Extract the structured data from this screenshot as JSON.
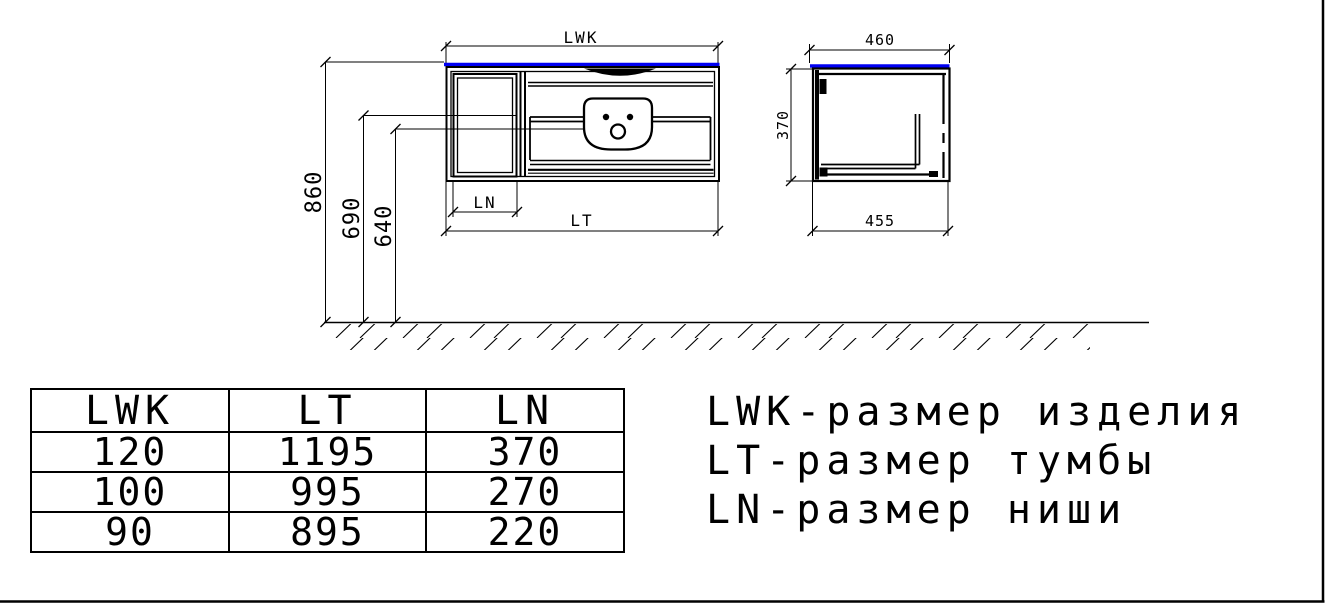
{
  "drawing": {
    "front_view": {
      "label_width_product": "LWK",
      "label_width_cabinet": "LT",
      "label_niche": "LN",
      "dim_height_total": "860",
      "dim_height_mid": "690",
      "dim_height_low": "640"
    },
    "side_view": {
      "dim_depth_top": "460",
      "dim_depth_bottom": "455",
      "dim_height": "370"
    },
    "colors": {
      "line": "#000000",
      "countertop_blue": "#0000f2",
      "background": "#ffffff"
    }
  },
  "size_table": {
    "headers": [
      "LWK",
      "LT",
      "LN"
    ],
    "rows": [
      [
        "120",
        "1195",
        "370"
      ],
      [
        "100",
        "995",
        "270"
      ],
      [
        "90",
        "895",
        "220"
      ]
    ]
  },
  "legend": {
    "line1": "LWK-размер изделия",
    "line2": "LT-размер тумбы",
    "line3": "LN-размер ниши"
  }
}
